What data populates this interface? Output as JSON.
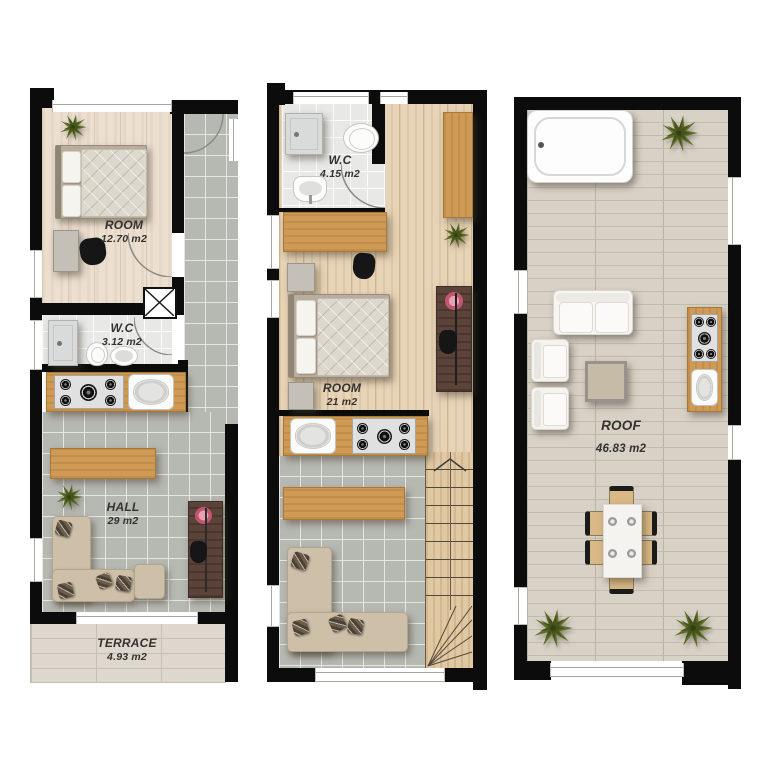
{
  "plans": [
    {
      "name": "first-floor",
      "rooms": [
        {
          "name": "ROOM",
          "area": "12.70 m2"
        },
        {
          "name": "W.C",
          "area": "3.12 m2"
        },
        {
          "name": "HALL",
          "area": "29 m2"
        },
        {
          "name": "TERRACE",
          "area": "4.93 m2"
        }
      ]
    },
    {
      "name": "second-floor",
      "rooms": [
        {
          "name": "W.C",
          "area": "4.15 m2"
        },
        {
          "name": "ROOM",
          "area": "21 m2"
        }
      ]
    },
    {
      "name": "roof-floor",
      "rooms": [
        {
          "name": "ROOF",
          "area": "46.83 m2"
        }
      ]
    }
  ],
  "colors": {
    "wall": "#0c0c0c",
    "wood_floor_light": "#ecdfd0",
    "wood_floor_warm": "#e7d3b6",
    "tile_gray": "#b6b8b2",
    "tile_white": "#e8e9e7",
    "terrace_tile": "#ddd7cd",
    "roof_tile": "#d8d1c6",
    "furniture_wood": "#cf9a55",
    "desk_dark_wood": "#5c433a",
    "sofa_beige": "#cdbfa8",
    "plant_green": "#5e6d26",
    "flower_pink": "#d4798f",
    "label_text": "#33322f"
  }
}
